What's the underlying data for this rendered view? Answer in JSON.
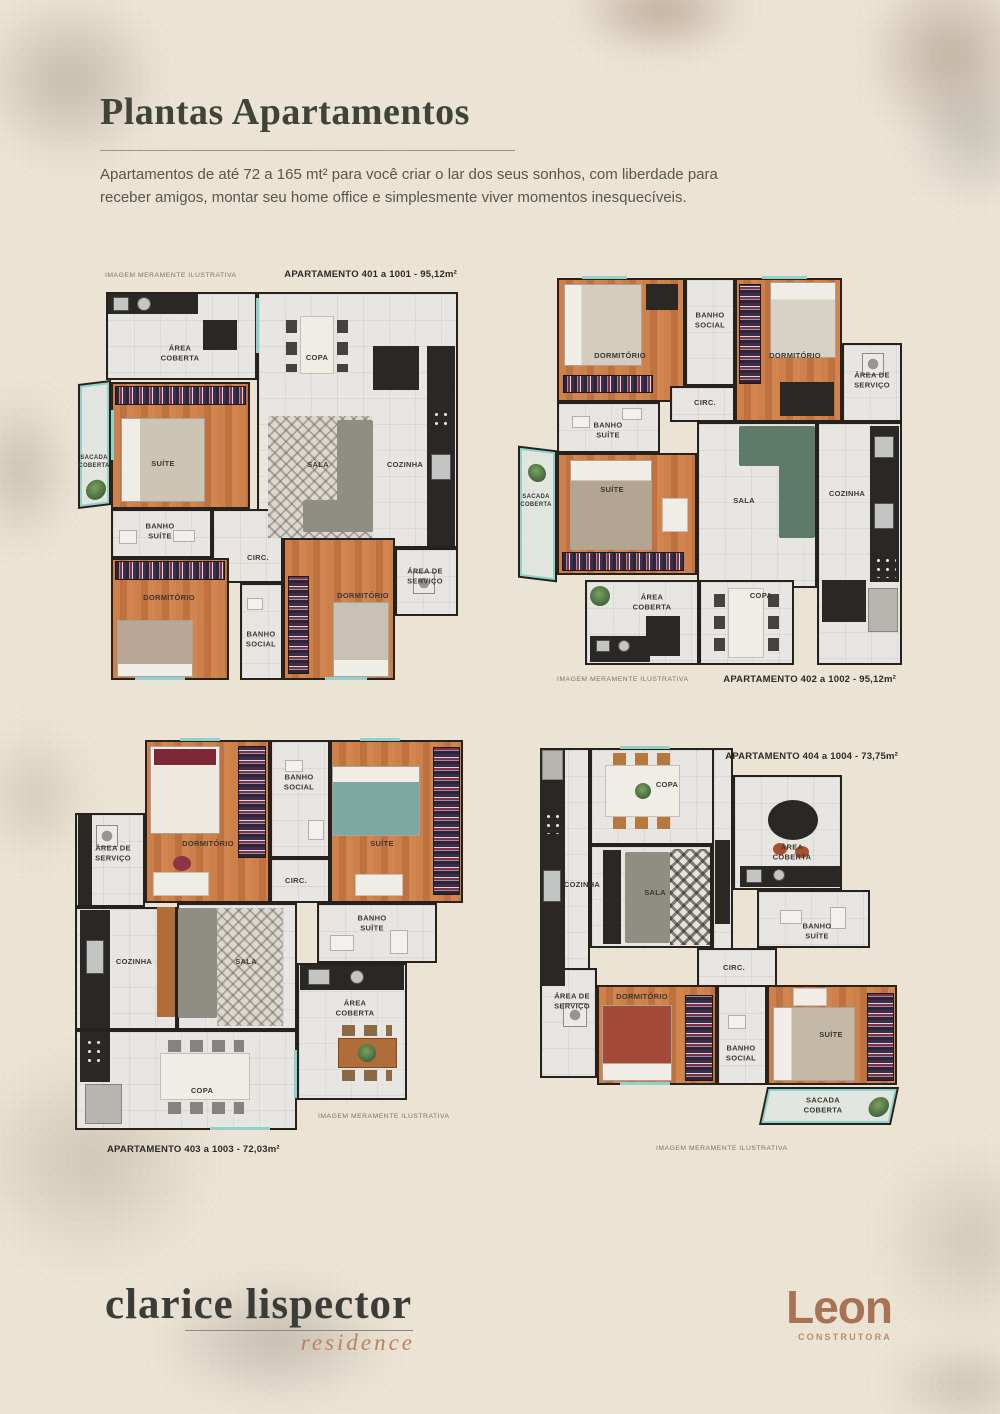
{
  "header": {
    "title": "Plantas Apartamentos",
    "intro": "Apartamentos de até 72 a 165 mt² para você criar o lar dos seus sonhos, com liberdade para receber amigos, montar seu home office e simplesmente viver momentos inesquecíveis."
  },
  "disclaimer": "IMAGEM MERAMENTE ILUSTRATIVA",
  "plans": [
    {
      "name": "apartamento-401",
      "caption": "APARTAMENTO 401 a 1001 - 95,12m²",
      "rooms": {
        "area_coberta": "ÁREA COBERTA",
        "copa": "COPA",
        "sala": "SALA",
        "cozinha": "COZINHA",
        "suite": "SUÍTE",
        "sacada": "SACADA COBERTA",
        "banho_suite": "BANHO SUÍTE",
        "circ": "CIRC.",
        "dormitorio_1": "DORMITÓRIO",
        "banho_social": "BANHO SOCIAL",
        "dormitorio_2": "DORMITÓRIO",
        "area_servico": "ÁREA DE SERVIÇO"
      }
    },
    {
      "name": "apartamento-402",
      "caption": "APARTAMENTO 402 a 1002 - 95,12m²",
      "rooms": {
        "dormitorio_1": "DORMITÓRIO",
        "banho_social": "BANHO SOCIAL",
        "dormitorio_2": "DORMITÓRIO",
        "area_servico": "ÁREA DE SERVIÇO",
        "circ": "CIRC.",
        "banho_suite": "BANHO SUÍTE",
        "suite": "SUÍTE",
        "sacada": "SACADA COBERTA",
        "sala": "SALA",
        "cozinha": "COZINHA",
        "area_coberta": "ÁREA COBERTA",
        "copa": "COPA"
      }
    },
    {
      "name": "apartamento-403",
      "caption": "APARTAMENTO 403 a 1003 - 72,03m²",
      "rooms": {
        "dormitorio": "DORMITÓRIO",
        "banho_social": "BANHO SOCIAL",
        "suite": "SUÍTE",
        "area_servico": "ÁREA DE SERVIÇO",
        "circ": "CIRC.",
        "banho_suite": "BANHO SUÍTE",
        "cozinha": "COZINHA",
        "sala": "SALA",
        "area_coberta": "ÁREA COBERTA",
        "copa": "COPA"
      }
    },
    {
      "name": "apartamento-404",
      "caption": "APARTAMENTO 404 a 1004 - 73,75m²",
      "rooms": {
        "copa": "COPA",
        "cozinha": "COZINHA",
        "sala": "SALA",
        "area_coberta": "ÁREA COBERTA",
        "banho_suite": "BANHO SUÍTE",
        "circ": "CIRC.",
        "area_servico": "ÁREA DE SERVIÇO",
        "dormitorio": "DORMITÓRIO",
        "banho_social": "BANHO SOCIAL",
        "suite": "SUÍTE",
        "sacada": "SACADA COBERTA"
      }
    }
  ],
  "footer": {
    "residence_name": "clarice lispector",
    "residence_sub": "residence",
    "builder": "Leon",
    "builder_sub": "CONSTRUTORA"
  },
  "colors": {
    "paper": "#ebe3d4",
    "wall": "#26211c",
    "wood_floor": "#c8773f",
    "tile_floor": "#e8e6e2",
    "glass": "#8fd2cb",
    "title_text": "#3f4338",
    "accent_script": "#bb8164",
    "builder_logo": "#a87355"
  }
}
